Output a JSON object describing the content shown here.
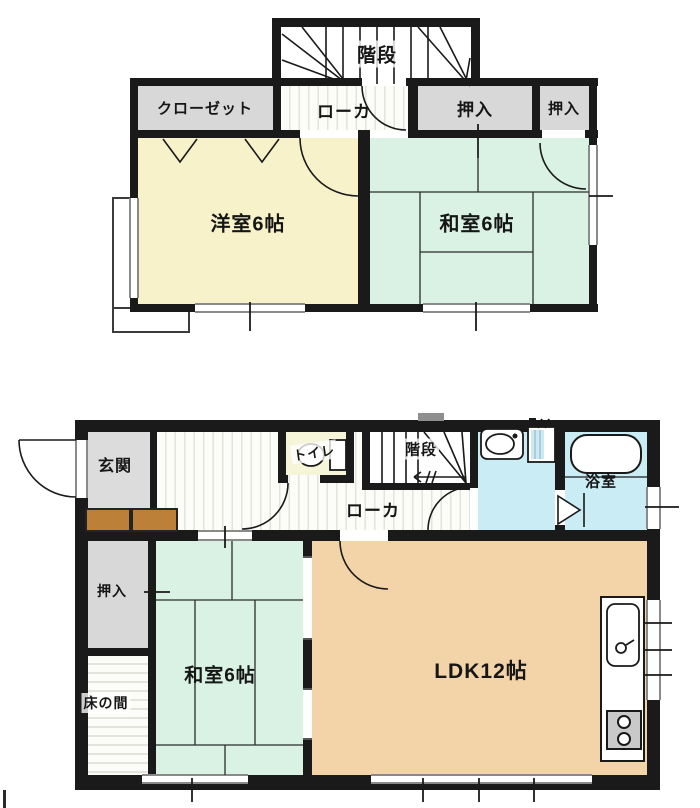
{
  "title": "2-story house floor plan",
  "colors": {
    "wall": "#1a1a1a",
    "western_room": "#f8f2cb",
    "tatami_room": "#d9f2e4",
    "ldk": "#f3d4a8",
    "closet_gray": "#d8d8d8",
    "toilet_room": "#f6f4d9",
    "wet_room": "#c9ecf5",
    "entrance_gray": "#dcdcdc",
    "step_brown": "#bc8038",
    "floor_stripe": "#e4e4dd",
    "line": "#1a1a1a"
  },
  "f2": {
    "stairs": "階段",
    "closet": "クローゼット",
    "hallway": "ローカ",
    "oshiire_1": "押入",
    "oshiire_2": "押入",
    "western_room": "洋室6帖",
    "tatami_room": "和室6帖"
  },
  "f1": {
    "entrance": "玄関",
    "toilet": "トイレ",
    "stairs": "階段",
    "bathroom": "浴室",
    "hallway": "ローカ",
    "oshiire": "押入",
    "tatami_room": "和室6帖",
    "tokonoma": "床の間",
    "ldk": "LDK12帖"
  }
}
